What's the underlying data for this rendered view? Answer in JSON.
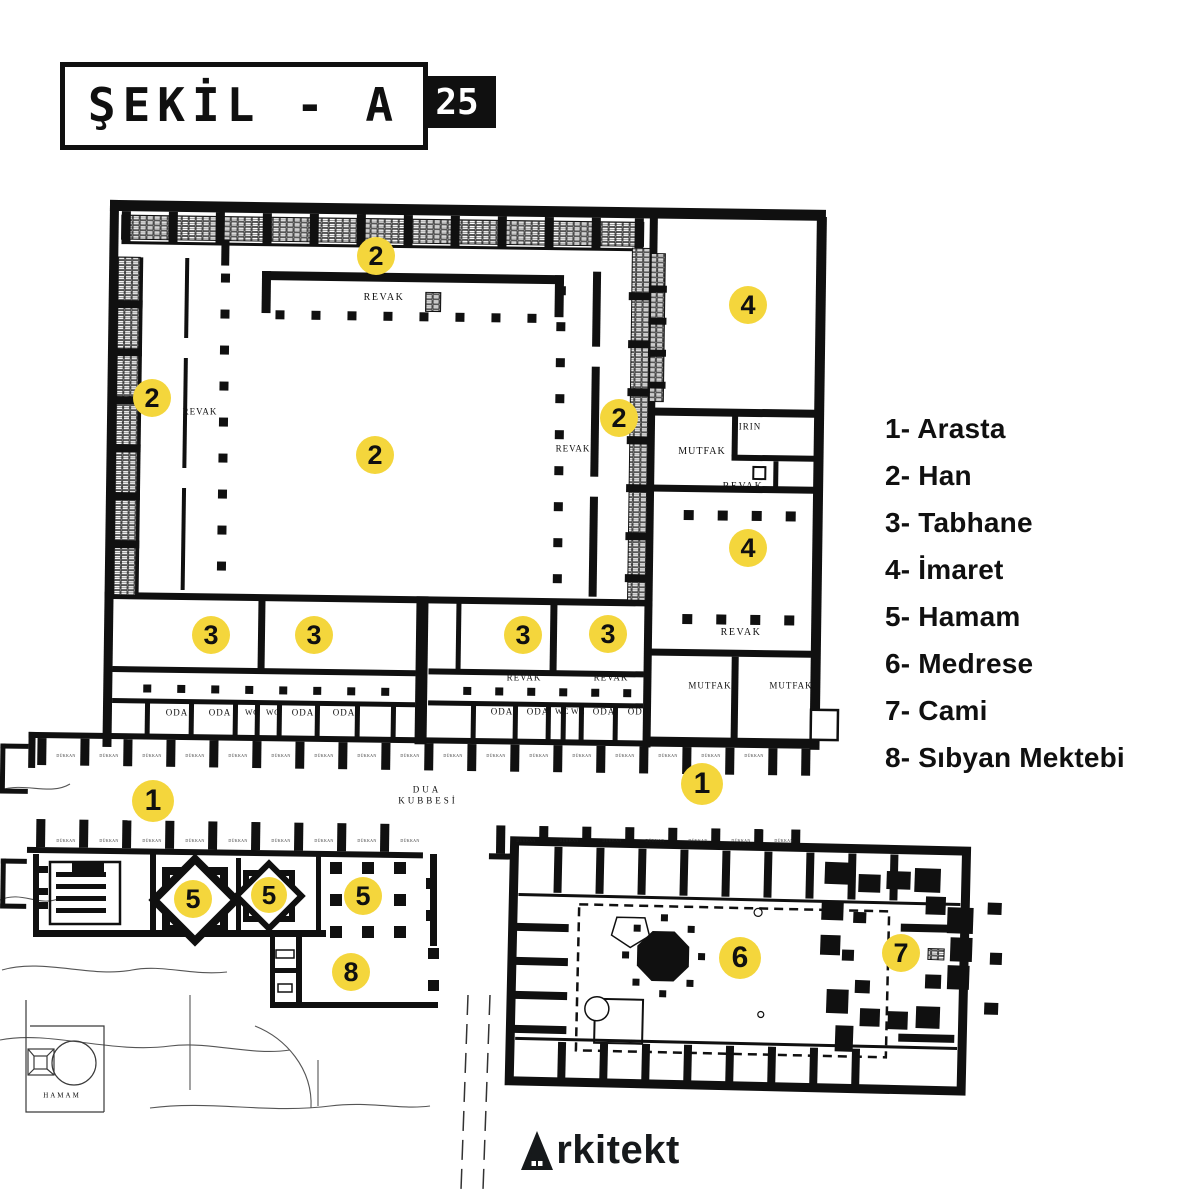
{
  "title": {
    "text": "ŞEKİL - A",
    "badge": "25"
  },
  "legend": {
    "items": [
      {
        "label": "1- Arasta"
      },
      {
        "label": "2- Han"
      },
      {
        "label": "3- Tabhane"
      },
      {
        "label": "4- İmaret"
      },
      {
        "label": "5- Hamam"
      },
      {
        "label": "6- Medrese"
      },
      {
        "label": "7- Cami"
      },
      {
        "label": "8- Sıbyan Mektebi"
      }
    ]
  },
  "brand": {
    "text": "Arkitekt",
    "rest": "rkitekt"
  },
  "colors": {
    "marker_yellow": "#F4D63C",
    "ink": "#101010"
  },
  "plan": {
    "markers": [
      {
        "n": "2",
        "x": 376,
        "y": 256,
        "d": 38
      },
      {
        "n": "2",
        "x": 152,
        "y": 398,
        "d": 38
      },
      {
        "n": "2",
        "x": 619,
        "y": 418,
        "d": 38
      },
      {
        "n": "2",
        "x": 375,
        "y": 455,
        "d": 38
      },
      {
        "n": "4",
        "x": 748,
        "y": 305,
        "d": 38
      },
      {
        "n": "4",
        "x": 748,
        "y": 548,
        "d": 38
      },
      {
        "n": "3",
        "x": 211,
        "y": 635,
        "d": 38
      },
      {
        "n": "3",
        "x": 314,
        "y": 635,
        "d": 38
      },
      {
        "n": "3",
        "x": 523,
        "y": 635,
        "d": 38
      },
      {
        "n": "3",
        "x": 608,
        "y": 634,
        "d": 38
      },
      {
        "n": "1",
        "x": 153,
        "y": 801,
        "d": 42
      },
      {
        "n": "1",
        "x": 702,
        "y": 784,
        "d": 42
      },
      {
        "n": "5",
        "x": 193,
        "y": 899,
        "d": 38
      },
      {
        "n": "5",
        "x": 269,
        "y": 895,
        "d": 36
      },
      {
        "n": "5",
        "x": 363,
        "y": 896,
        "d": 38
      },
      {
        "n": "8",
        "x": 351,
        "y": 972,
        "d": 38
      },
      {
        "n": "6",
        "x": 740,
        "y": 958,
        "d": 42
      },
      {
        "n": "7",
        "x": 901,
        "y": 953,
        "d": 38
      }
    ],
    "room_labels": [
      {
        "t": "REVAK",
        "x": 384,
        "y": 298,
        "s": 10,
        "ls": 1.5
      },
      {
        "t": "REVAK",
        "x": 200,
        "y": 412,
        "s": 9,
        "ls": 1
      },
      {
        "t": "REVAK",
        "x": 573,
        "y": 449,
        "s": 9,
        "ls": 1
      },
      {
        "t": "REVAK",
        "x": 743,
        "y": 487,
        "s": 10,
        "ls": 1.5
      },
      {
        "t": "REVAK",
        "x": 741,
        "y": 633,
        "s": 10,
        "ls": 1.5
      },
      {
        "t": "REVAK",
        "x": 524,
        "y": 678,
        "s": 9,
        "ls": 1
      },
      {
        "t": "REVAK",
        "x": 611,
        "y": 678,
        "s": 9,
        "ls": 1
      },
      {
        "t": "FIRIN",
        "x": 747,
        "y": 427,
        "s": 9,
        "ls": 1
      },
      {
        "t": "MUTFAK",
        "x": 702,
        "y": 452,
        "s": 10,
        "ls": 1
      },
      {
        "t": "MUTFAK",
        "x": 710,
        "y": 686,
        "s": 9,
        "ls": 1
      },
      {
        "t": "MUTFAK",
        "x": 791,
        "y": 686,
        "s": 9,
        "ls": 1
      },
      {
        "t": "ODA",
        "x": 177,
        "y": 713,
        "s": 9,
        "ls": 1
      },
      {
        "t": "ODA",
        "x": 220,
        "y": 713,
        "s": 9,
        "ls": 1
      },
      {
        "t": "WC",
        "x": 252,
        "y": 713,
        "s": 8,
        "ls": 0.5
      },
      {
        "t": "WC",
        "x": 273,
        "y": 713,
        "s": 8,
        "ls": 0.5
      },
      {
        "t": "ODA",
        "x": 303,
        "y": 713,
        "s": 9,
        "ls": 1
      },
      {
        "t": "ODA",
        "x": 344,
        "y": 713,
        "s": 9,
        "ls": 1
      },
      {
        "t": "ODA",
        "x": 502,
        "y": 712,
        "s": 9,
        "ls": 1
      },
      {
        "t": "ODA",
        "x": 538,
        "y": 712,
        "s": 9,
        "ls": 1
      },
      {
        "t": "WC",
        "x": 562,
        "y": 712,
        "s": 8,
        "ls": 0.5
      },
      {
        "t": "WC",
        "x": 578,
        "y": 712,
        "s": 8,
        "ls": 0.5
      },
      {
        "t": "ODA",
        "x": 604,
        "y": 712,
        "s": 9,
        "ls": 1
      },
      {
        "t": "ODA",
        "x": 639,
        "y": 712,
        "s": 9,
        "ls": 1
      },
      {
        "t": "DUA",
        "x": 427,
        "y": 790,
        "s": 9,
        "ls": 3
      },
      {
        "t": "KUBBESİ",
        "x": 428,
        "y": 801,
        "s": 9,
        "ls": 3
      },
      {
        "t": "HAMAM",
        "x": 62,
        "y": 1096,
        "s": 7,
        "ls": 2
      }
    ],
    "shop_label": "DÜKKAN",
    "shop_rows": [
      {
        "y": 756,
        "xs": [
          66,
          109,
          152,
          195,
          238,
          281,
          324,
          367,
          410,
          453,
          496,
          539,
          582,
          625,
          668,
          711,
          754
        ]
      },
      {
        "y": 841,
        "xs": [
          66,
          109,
          152,
          195,
          238,
          281,
          324,
          367,
          410,
          526,
          569,
          612,
          655,
          698,
          741,
          784
        ]
      }
    ]
  }
}
